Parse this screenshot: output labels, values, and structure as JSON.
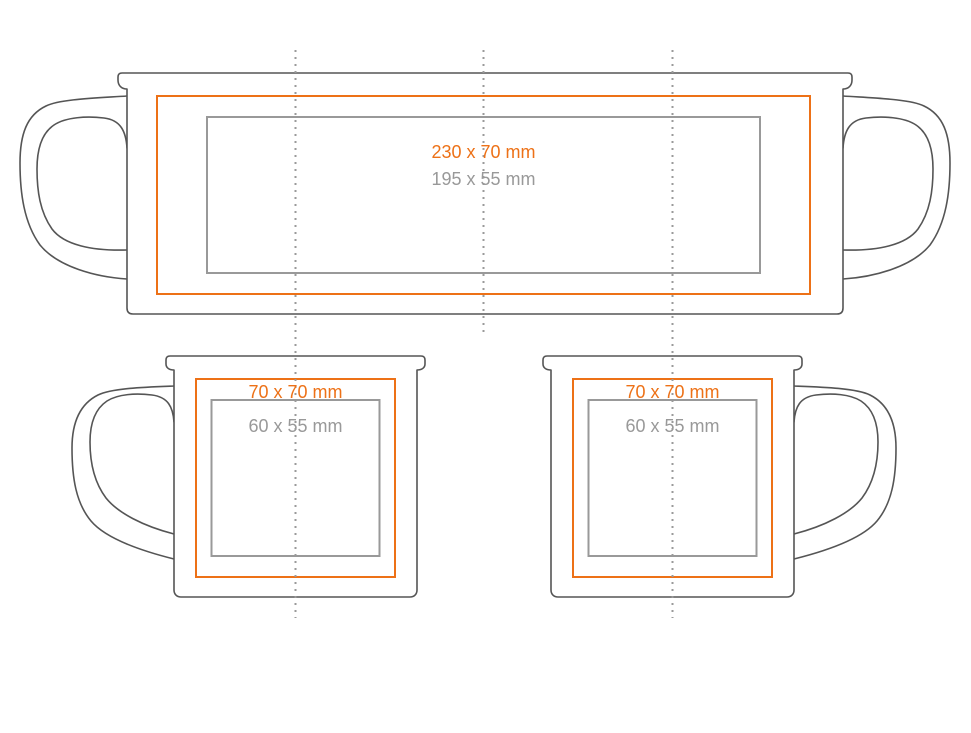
{
  "colors": {
    "print_area": "#ED7117",
    "safe_area": "#999999",
    "outline": "#555555",
    "fold_line": "#9A9A9A",
    "background": "#FFFFFF"
  },
  "views": {
    "wrap": {
      "print_label": "230 x 70 mm",
      "safe_label": "195 x 55 mm"
    },
    "side_handle_left": {
      "print_label": "70 x 70 mm",
      "safe_label": "60 x 55 mm"
    },
    "side_handle_right": {
      "print_label": "70 x 70 mm",
      "safe_label": "60 x 55 mm"
    }
  }
}
